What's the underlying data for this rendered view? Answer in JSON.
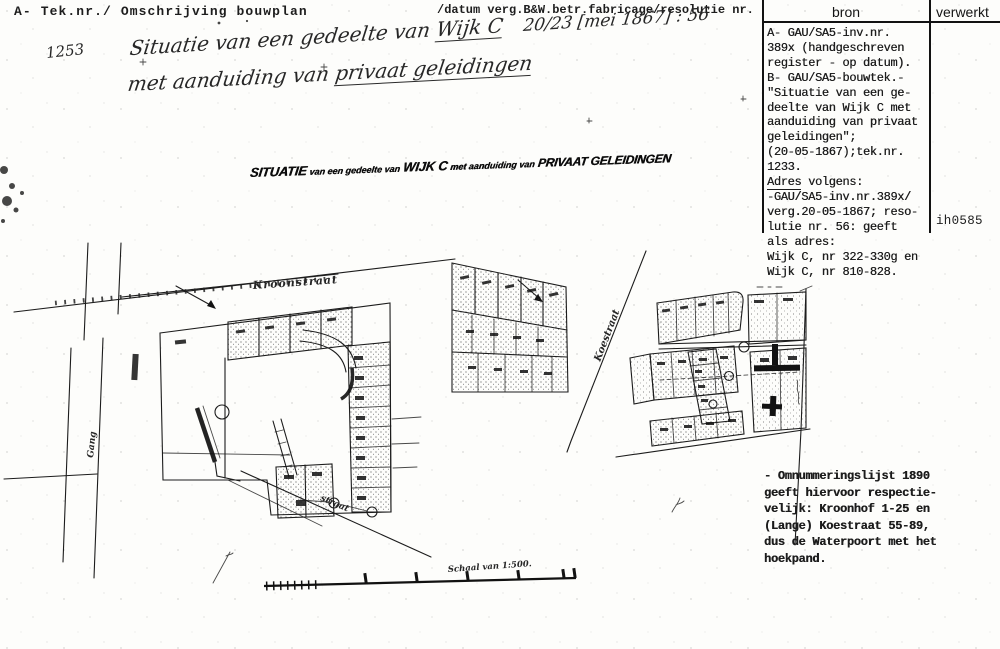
{
  "header": {
    "left": "A- Tek.nr./ Omschrijving bouwplan",
    "center": "/datum verg.B&W.betr.fabricage/resolutie nr."
  },
  "bron": {
    "header_bron": "bron",
    "header_verwerkt": "verwerkt",
    "lines_a": [
      "A- GAU/SA5-inv.nr.",
      "389x (handgeschreven",
      "register - op datum).",
      "B- GAU/SA5-bouwtek.-",
      "\"Situatie van een ge-",
      "deelte van Wijk C met",
      "aanduiding van privaat",
      "geleidingen\";",
      "(20-05-1867);tek.nr.",
      "1233."
    ],
    "adres_label": "Adres",
    "adres_rest": " volgens:",
    "lines_b": [
      "-GAU/SA5-inv.nr.389x/",
      "verg.20-05-1867; reso-",
      "lutie nr. 56: geeft",
      "als adres:",
      "Wijk C, nr 322-330g en",
      "Wijk C, nr 810-828."
    ],
    "code": "ih0585"
  },
  "handwritten": {
    "number": "1253",
    "line1_text": "Situatie van een gedeelte van ",
    "line1_underlined": "Wijk C",
    "line1_date": "20/23 [mei 1867] : 56",
    "line2_text": "met aanduiding van ",
    "line2_underlined": "privaat geleidingen"
  },
  "stamp": {
    "w1": "SITUATIE",
    "w2": "van een gedeelte van",
    "w3": "WIJK C",
    "w4": "met aanduiding van",
    "w5": "PRIVAAT GELEIDINGEN"
  },
  "note": {
    "lines": [
      "- Omnummeringslijst 1890",
      "geeft hiervoor respectie-",
      "velijk: Kroonhof 1-25 en",
      "(Lange) Koestraat 55-89,",
      "dus de Waterpoort met het",
      "hoekpand."
    ]
  },
  "map_labels": {
    "kroonstraat": "Kroonstraat",
    "gang": "Gang",
    "straat": "straat",
    "koestraat": "Koestraat",
    "schaal": "Schaal van 1:500."
  },
  "ink_color": "#1c1c1c"
}
